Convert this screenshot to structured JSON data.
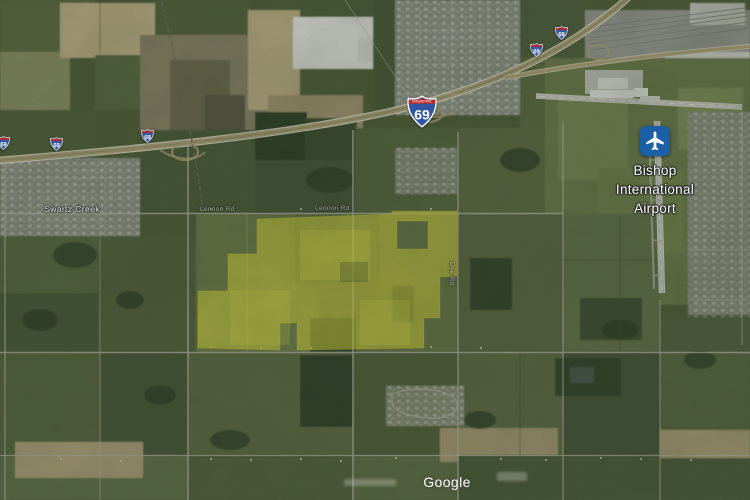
{
  "map": {
    "watermark": "Google",
    "poi_airport": {
      "line1": "Bishop",
      "line2": "International",
      "line3": "Airport",
      "icon": "airplane-icon",
      "icon_bg_color": "#1b5fa7"
    },
    "town_label": "Swartz Creek",
    "road_labels": {
      "north_road": "Lennon Rd",
      "east_road": "Dye Rd"
    },
    "route_shields": {
      "banner": "INTERSTATE",
      "number": "69"
    },
    "parcel_overlay": {
      "color": "#e6e135"
    }
  }
}
